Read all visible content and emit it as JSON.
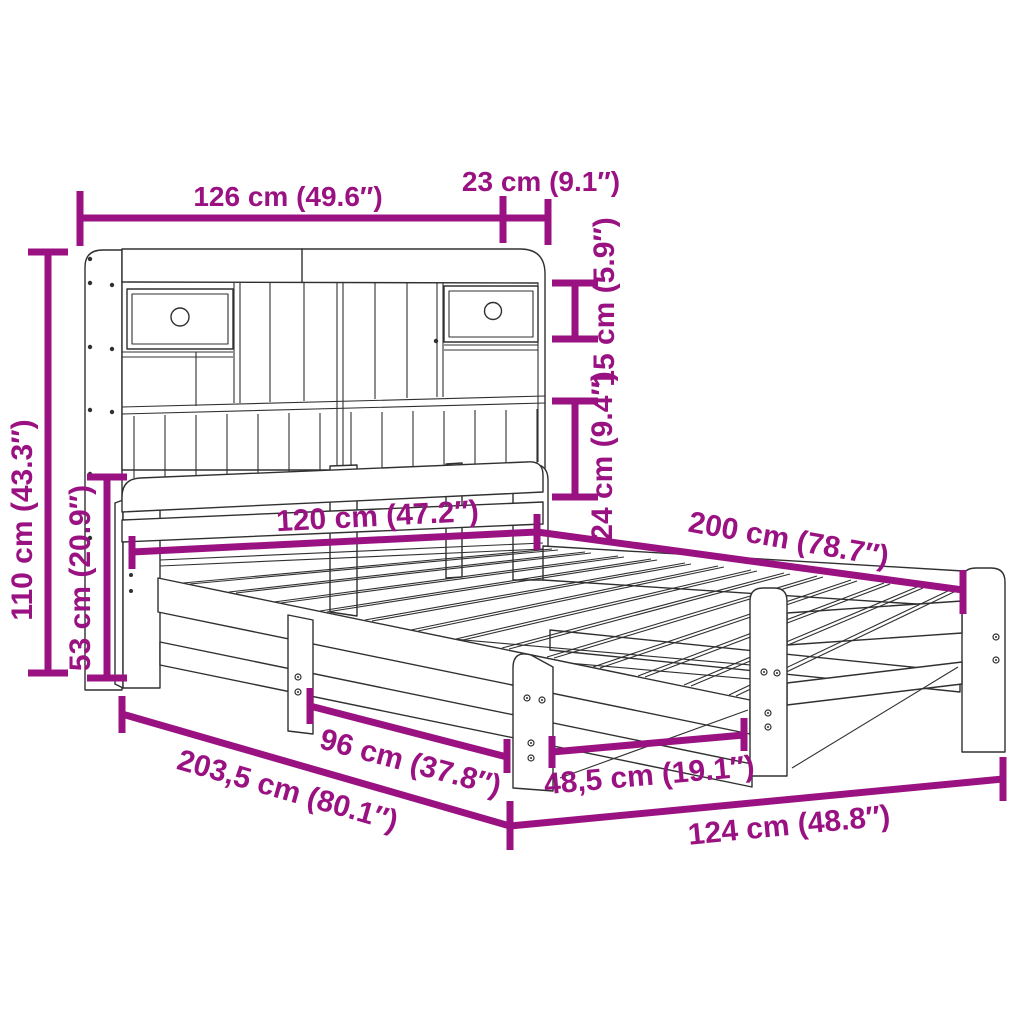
{
  "diagram": {
    "type": "product-dimension-diagram",
    "subject": "bed-frame-with-bookcase-headboard",
    "colors": {
      "accent": "#9A1282",
      "line_art": "#303030",
      "background": "#ffffff"
    },
    "labels": {
      "headboard_width": "126 cm (49.6″)",
      "headboard_depth": "23 cm (9.1″)",
      "top_shelf_height": "15 cm (5.9″)",
      "lower_shelf_height": "24 cm (9.4″)",
      "total_height": "110 cm (43.3″)",
      "headboard_panel_height": "53 cm (20.9″)",
      "mattress_width": "120 cm (47.2″)",
      "mattress_length": "200 cm (78.7″)",
      "total_length": "203,5 cm (80.1″)",
      "leg_spacing_wide": "96 cm (37.8″)",
      "leg_spacing_narrow": "48,5 cm (19.1″)",
      "frame_outer_width": "124 cm (48.8″)"
    }
  }
}
